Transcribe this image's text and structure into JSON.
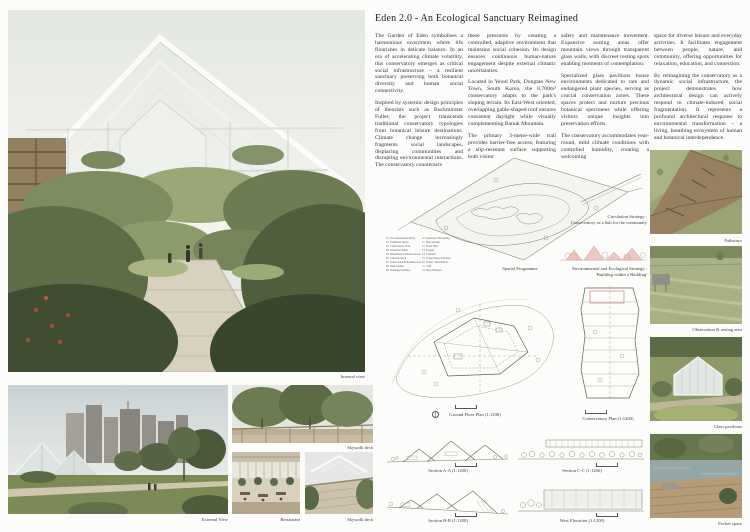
{
  "page": {
    "title": "Eden 2.0 - An Ecological Sanctuary Reimagined"
  },
  "essay": {
    "col1": [
      "The Garden of Eden symbolises a harmonious ecosystem where life flourishes in delicate balance. In an era of accelerating climate volatility, this conservatory emerges as critical social infrastructure – a resilient sanctuary preserving both botanical diversity and human social connectivity.",
      "Inspired by systemic design principles of theorists such as Buckminster Fuller, the project transcends traditional conservatory typologies from botanical leisure destinations. Climate change increasingly fragments social landscapes, displacing communities and disrupting environmental interactions. The conservatory counteracts"
    ],
    "col2": [
      "these pressures by creating a controlled, adaptive environment that maintains social cohesion. Its design ensures continuous human-nature engagement despite external climatic uncertainties.",
      "Located in Yeoul Park, Dongtan New Town, South Korea, the 8,700m² conservatory adapts to the park's sloping terrain. Its East-West oriented, overlapping gable-shaped roof ensures consistent daylight while visually complementing Banuk Mountain.",
      "The primary 3-metre-wide trail provides barrier-free access, featuring a slip-resistant surface supporting both visitor"
    ],
    "col3": [
      "safety and maintenance movement. Expansive seating areas offer mountain views through transparent glass walls, with discreet resting spots enabling moments of contemplation.",
      "Specialized glass pavilions house environments dedicated to rare and endangered plant species, serving as crucial conservation zones. These spaces protect and nurture precious botanical specimens while offering visitors unique insights into preservation efforts.",
      "The conservatory accommodates year-round, mild climate conditions with controlled humidity, creating a welcoming"
    ],
    "col4": [
      "space for diverse leisure and everyday activities. It facilitates engagement between people, nature, and community, offering opportunities for relaxation, education, and connection.",
      "By reimagining the conservatory as a dynamic social infrastructure, the project demonstrates how architectural design can actively respond to climate-induced social fragmentation. It represents a profound architectural response to environmental transformation – a living, breathing ecosystem of human and botanical interdependence."
    ]
  },
  "legend": {
    "col1": "01  Tree Observation Deck\n02  Exhibition Space\n03  Conservatory Trail\n04  Waterfront Deck\n05  Maintenance Vehicle Access\n06  Lakeside Deck\n07  Observation & Reading Area\n08  Rain Garden\n09  Drainage Facilities",
    "col2": "10  Rainwater Harvesting\n11  Herb Garden\n12  Event Hall\n13  Fernery\n14  Cafeteria\n15  Conservatory Entrance\n16  Ticket / Information\n17  Café\n18  Shop Entrance"
  },
  "captions": {
    "internal_view": "Internal view",
    "spatial_programme": "Spatial Programme",
    "circulation_strategy": "Circulation Strategy :\nConservatory as a hub for the community",
    "environmental_strategy": "Environmental and Ecological Strategy :\n'Building within a Building'",
    "pathways": "Pathways",
    "observation": "Observation & resting area",
    "glass_pavilions": "Glass pavilions",
    "pocket_space": "Pocket space",
    "ground_floor_plan": "Ground Floor Plan (1:1200)",
    "conservatory_plan": "Conservatory Plan (1:1200)",
    "section_aa": "Section A-A (1:1200)",
    "section_cc": "Section C-C (1:1200)",
    "section_bb": "Section B-B (1:1200)",
    "west_elevation": "West Elevation (1:1200)",
    "external_view": "External View",
    "skywalk_deck_upper": "Skywalk deck",
    "restaurant": "Restaurant",
    "skywalk_deck_lower": "Skywalk deck"
  },
  "colors": {
    "accent_pink": "#d99288",
    "drawing_line": "#6a6a6a",
    "foliage": "#5d6d46"
  }
}
